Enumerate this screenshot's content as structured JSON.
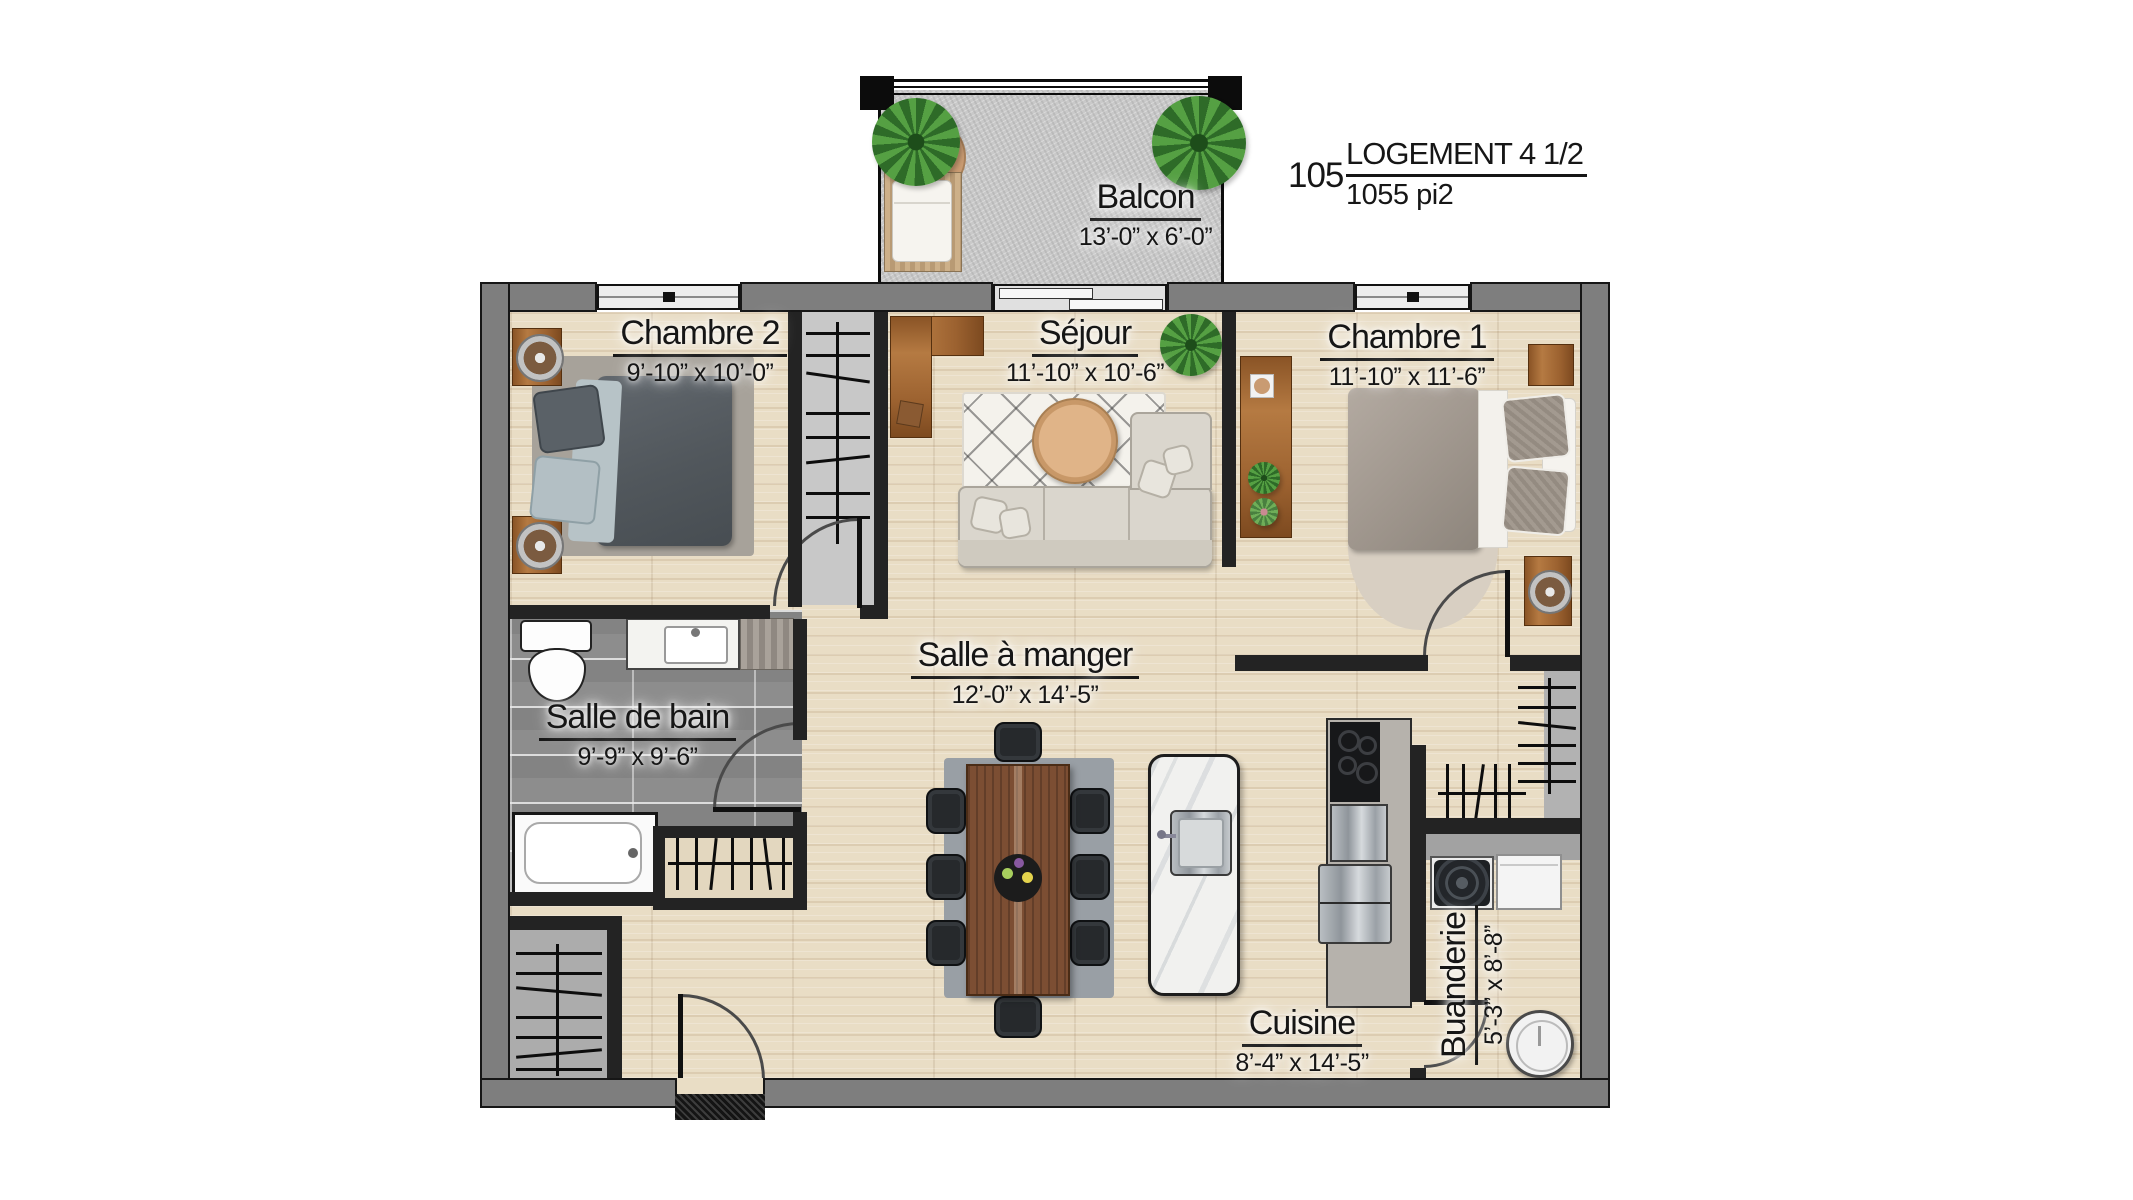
{
  "title": {
    "unit_number": "105",
    "unit_type": "LOGEMENT 4 1/2",
    "area": "1055 pi2"
  },
  "rooms": {
    "balcon": {
      "name": "Balcon",
      "dimensions": "13’-0” x 6’-0”"
    },
    "chambre2": {
      "name": "Chambre 2",
      "dimensions": "9’-10” x 10’-0”"
    },
    "sejour": {
      "name": "Séjour",
      "dimensions": "11’-10” x 10’-6”"
    },
    "chambre1": {
      "name": "Chambre 1",
      "dimensions": "11’-10” x 11’-6”"
    },
    "salle_de_bain": {
      "name": "Salle de bain",
      "dimensions": "9’-9” x 9’-6”"
    },
    "salle_a_manger": {
      "name": "Salle à manger",
      "dimensions": "12’-0” x 14’-5”"
    },
    "cuisine": {
      "name": "Cuisine",
      "dimensions": "8’-4” x 14’-5”"
    },
    "buanderie": {
      "name": "Buanderie",
      "dimensions": "5’-3” x 8’-8”"
    }
  },
  "colors": {
    "wall_outer": "#7e7e7e",
    "wall_interior": "#232323",
    "wood_floor": "#e9ddc5",
    "tile_floor": "#8d8d8d",
    "concrete": "#c9c9c9",
    "wood_furniture": "#a9713d",
    "text": "#161616"
  }
}
